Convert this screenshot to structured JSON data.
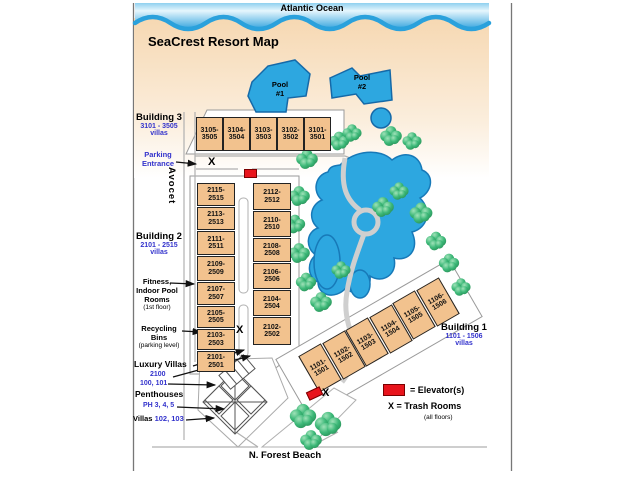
{
  "header": {
    "ocean": "Atlantic Ocean",
    "title": "SeaCrest Resort Map"
  },
  "streets": {
    "left": "Avocet",
    "bottom": "N. Forest Beach"
  },
  "pools": {
    "pool1": {
      "line1": "Pool",
      "line2": "#1"
    },
    "pool2": {
      "line1": "Pool",
      "line2": "#2"
    }
  },
  "building3": {
    "name": "Building 3",
    "range": "3101 - 3505",
    "sub": "villas",
    "units": [
      {
        "top": "3105-",
        "bottom": "3505"
      },
      {
        "top": "3104-",
        "bottom": "3504"
      },
      {
        "top": "3103-",
        "bottom": "3503"
      },
      {
        "top": "3102-",
        "bottom": "3502"
      },
      {
        "top": "3101-",
        "bottom": "3501"
      }
    ]
  },
  "building2": {
    "name": "Building 2",
    "range": "2101 - 2515",
    "sub": "villas",
    "left_units": [
      {
        "top": "2115-",
        "bottom": "2515"
      },
      {
        "top": "2113-",
        "bottom": "2513"
      },
      {
        "top": "2111-",
        "bottom": "2511"
      },
      {
        "top": "2109-",
        "bottom": "2509"
      },
      {
        "top": "2107-",
        "bottom": "2507"
      },
      {
        "top": "2105-",
        "bottom": "2505"
      },
      {
        "top": "2103-",
        "bottom": "2503"
      },
      {
        "top": "2101-",
        "bottom": "2501"
      }
    ],
    "right_units": [
      {
        "top": "2112-",
        "bottom": "2512"
      },
      {
        "top": "2110-",
        "bottom": "2510"
      },
      {
        "top": "2108-",
        "bottom": "2508"
      },
      {
        "top": "2106-",
        "bottom": "2506"
      },
      {
        "top": "2104-",
        "bottom": "2504"
      },
      {
        "top": "2102-",
        "bottom": "2502"
      }
    ]
  },
  "building1": {
    "name": "Building 1",
    "range": "1101 - 1506",
    "sub": "villas",
    "units": [
      {
        "top": "1101-",
        "bottom": "1501"
      },
      {
        "top": "1102-",
        "bottom": "1502"
      },
      {
        "top": "1103-",
        "bottom": "1503"
      },
      {
        "top": "1104-",
        "bottom": "1504"
      },
      {
        "top": "1105-",
        "bottom": "1505"
      },
      {
        "top": "1106-",
        "bottom": "1506"
      }
    ]
  },
  "callouts": {
    "parking": {
      "line1": "Parking",
      "line2": "Entrance"
    },
    "fitness": {
      "line1": "Fitness,",
      "line2": "Indoor Pool",
      "line3": "Rooms",
      "line4": "(1st floor)"
    },
    "recycling": {
      "line1": "Recycling",
      "line2": "Bins",
      "line3": "(parking level)"
    },
    "luxury": {
      "name": "Luxury Villas",
      "unit": "2100",
      "units2": "100, 101"
    },
    "penthouses": {
      "name": "Penthouses",
      "units": "PH 3, 4, 5"
    },
    "villas": {
      "name": "Villas",
      "units": "102, 103"
    }
  },
  "legend": {
    "elevator": "= Elevator(s)",
    "trash": "X = Trash Rooms",
    "trash_sub": "(all floors)"
  },
  "marks": {
    "trash_x": "X"
  },
  "colors": {
    "building_fill": "#f2c28e",
    "water_blue": "#2da7e0",
    "tree_green": "#3cb878",
    "blue_text": "#3333cc",
    "elevator_red": "#e8141c",
    "sand": "#f6d8b2"
  }
}
